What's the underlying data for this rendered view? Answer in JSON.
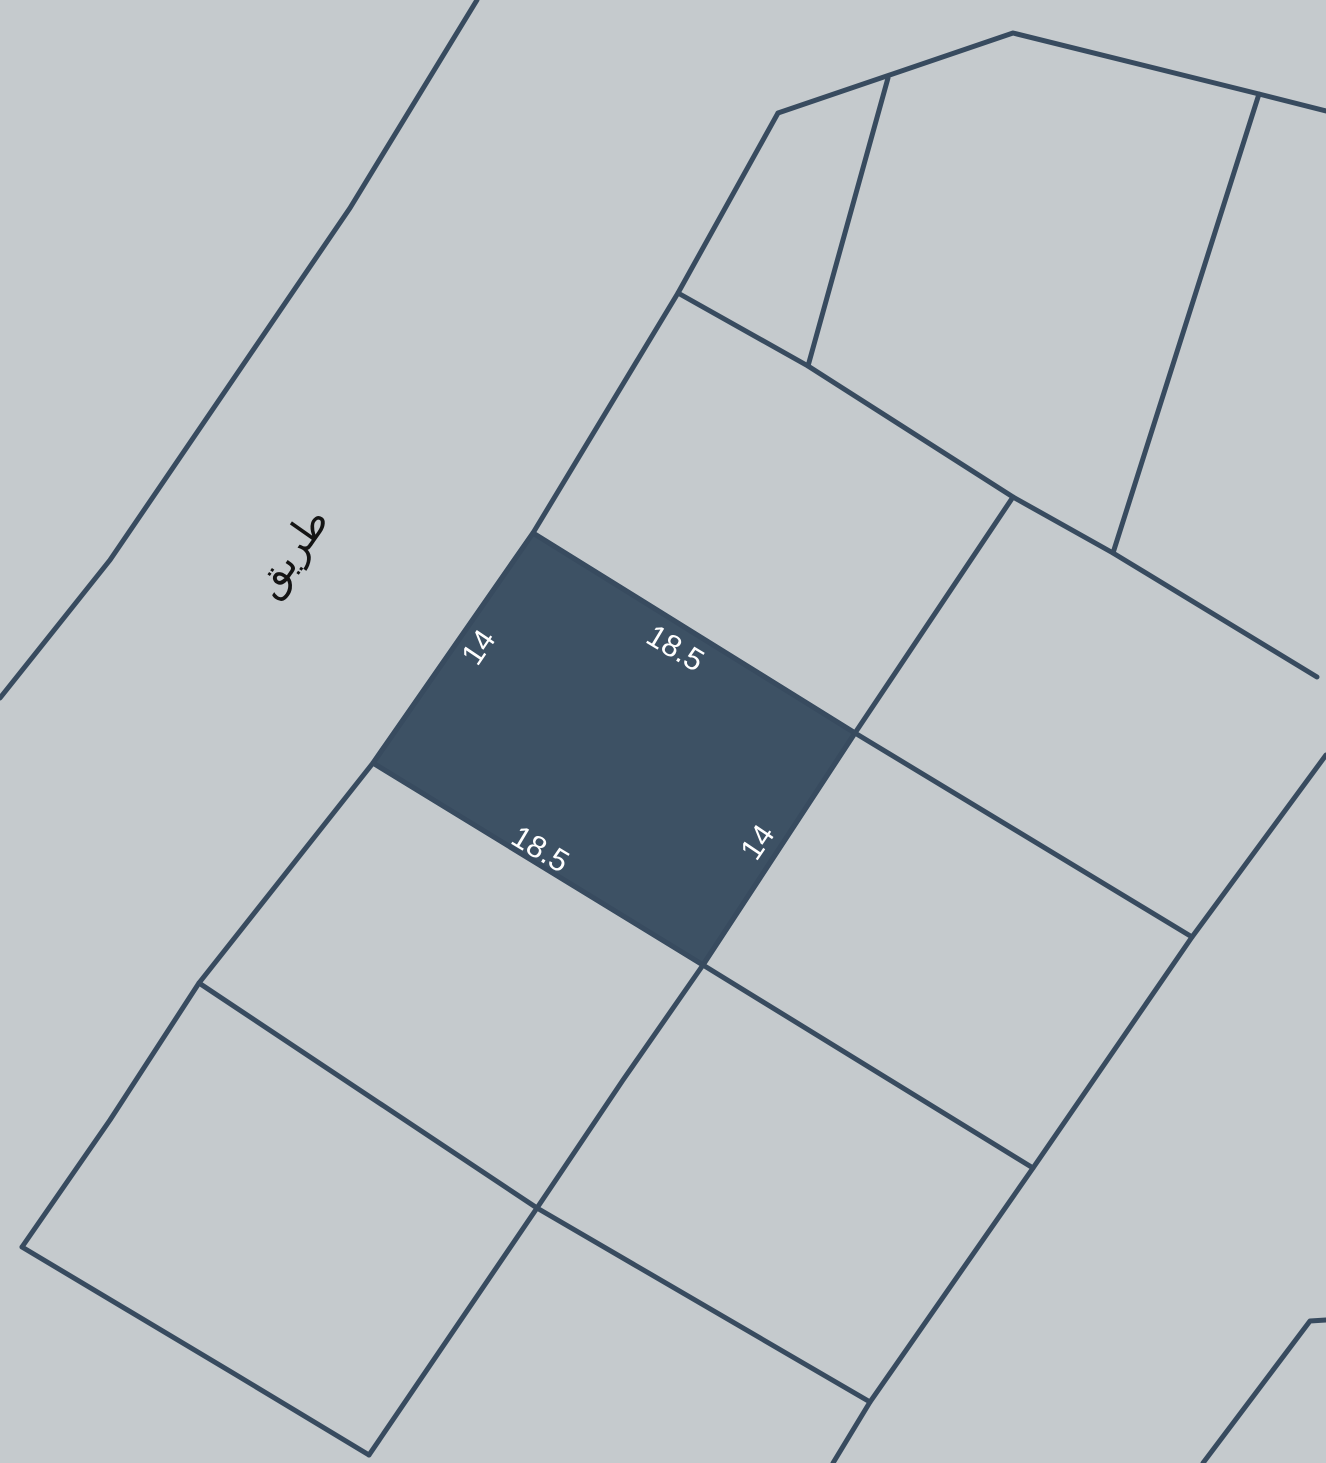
{
  "map": {
    "background_color": "#c5cacd",
    "line_color": "#384b5f",
    "line_width": 5,
    "road_label": {
      "text": "طريق",
      "color": "#141414",
      "x": 302,
      "y": 560,
      "rotate": -55
    },
    "highlight_parcel": {
      "fill": "#3d5164",
      "points": "533,533 855,733 703,965 373,763",
      "dimension_labels": [
        {
          "text": "18.5",
          "color": "#ffffff",
          "x": 670,
          "y": 657,
          "rotate": 31
        },
        {
          "text": "14",
          "color": "#ffffff",
          "x": 487,
          "y": 653,
          "rotate": -56
        },
        {
          "text": "18.5",
          "color": "#ffffff",
          "x": 535,
          "y": 858,
          "rotate": 31
        },
        {
          "text": "14",
          "color": "#ffffff",
          "x": 766,
          "y": 848,
          "rotate": -56
        }
      ]
    },
    "boundary_lines": [
      {
        "name": "road-west-edge",
        "points": "477,0 350,208 110,560 0,698"
      },
      {
        "name": "road-east-edge",
        "points": "778,113 678,293 533,533 373,763 199,983 110,1120 22,1247"
      },
      {
        "name": "block-north-edge",
        "points": "778,113 1013,33 1259,94 1326,111"
      },
      {
        "name": "upper-divider",
        "points": "888,78 808,366"
      },
      {
        "name": "central-spine",
        "points": "678,293 808,366 1013,497 1113,553 1317,677"
      },
      {
        "name": "northeast-divider",
        "points": "1259,94 1113,553"
      },
      {
        "name": "east-divider",
        "points": "1013,497 855,733 703,965"
      },
      {
        "name": "parcel-north-edge",
        "points": "533,533 855,733"
      },
      {
        "name": "parcel-south-edge",
        "points": "373,763 703,965"
      },
      {
        "name": "southeast-divider",
        "points": "855,733 1192,937"
      },
      {
        "name": "east-boundary",
        "points": "1326,755 1192,937 1033,1168 870,1402 833,1463"
      },
      {
        "name": "lower-divider",
        "points": "703,965 1033,1168"
      },
      {
        "name": "south-divider",
        "points": "703,965 623,1080 537,1208 369,1455"
      },
      {
        "name": "southwest-spine",
        "points": "199,983 537,1208 870,1402"
      },
      {
        "name": "southwest-edge",
        "points": "22,1247 233,1373 369,1455"
      },
      {
        "name": "corner-line-southeast",
        "points": "1326,1320 1310,1321 1203,1463"
      }
    ]
  }
}
